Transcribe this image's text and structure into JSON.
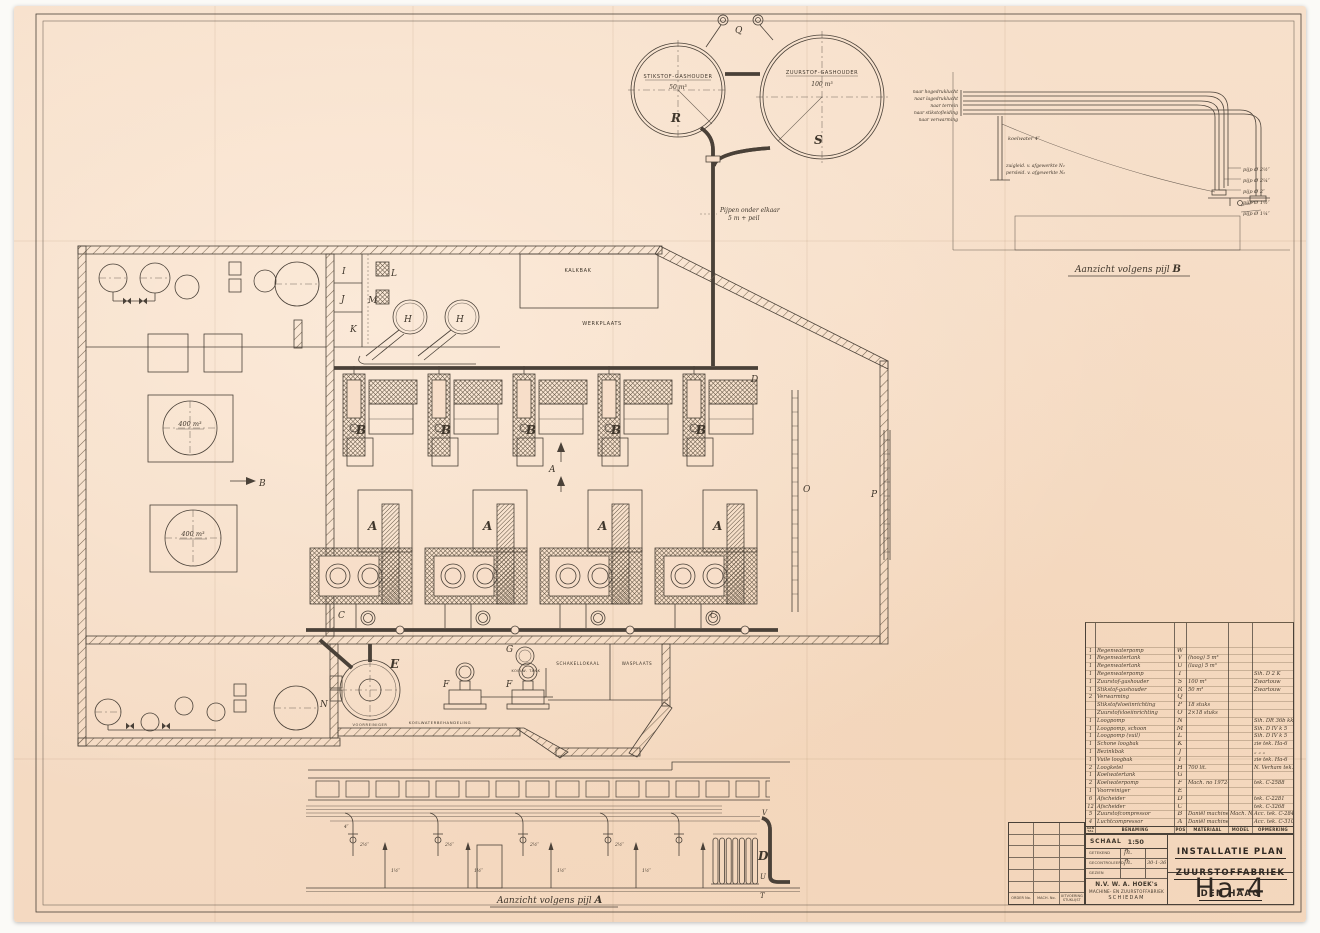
{
  "colors": {
    "paper": "#f6dcc6",
    "ink": "#4a4138"
  },
  "gas_holders": {
    "nitrogen": {
      "label": "STIKSTOF-GASHOUDER",
      "capacity": "50 m³",
      "letter": "R"
    },
    "oxygen": {
      "label": "ZUURSTOF-GASHOUDER",
      "capacity": "100 m³",
      "letter": "S"
    },
    "vent_letter": "Q",
    "pipe_note_line1": "Pijpen onder elkaar",
    "pipe_note_line2": "5 m + peil"
  },
  "view_b": {
    "caption_text": "Aanzicht volgens pijl ",
    "caption_letter": "B",
    "left_labels": [
      "naar hogedruklucht",
      "naar lagedruklucht",
      "naar terrein",
      "naar stikstofleiding",
      "naar verwarming"
    ],
    "right_labels": [
      "pijp Ø 2½″",
      "pijp Ø 2¼″",
      "pijp Ø 2″",
      "pijp Ø 1½″",
      "pijp Ø 1¼″"
    ],
    "support_label": "koelwater 4″",
    "note_line1": "zuigleid. v. afgewerkte N₂",
    "note_line2": "persleid. v. afgewerkte N₂"
  },
  "view_a": {
    "caption_text": "Aanzicht volgens pijl ",
    "caption_letter": "A",
    "letters": {
      "d": "D",
      "t": "T",
      "u": "U",
      "v": "V"
    },
    "pipe_sizes": [
      "4″",
      "2½″",
      "1½″"
    ]
  },
  "plan": {
    "rooms": {
      "kalkbak": "KALKBAK",
      "werkplaats": "WERKPLAATS",
      "schakellokaal": "SCHAKELLOKAAL",
      "wasplaats": "WASPLAATS",
      "koelwaterbehandeling": "KOELWATERBEHANDELING",
      "koelw_tank": "KOELW. TANK",
      "voorreiniger": "VOORREINIGER"
    },
    "tanks": {
      "basin1": "400 m³",
      "basin2": "400 m³"
    },
    "machine_letters": {
      "a": "A",
      "b": "B",
      "c": "C",
      "d": "D",
      "e": "E",
      "f": "F",
      "g": "G",
      "h": "H",
      "i": "I",
      "j": "J",
      "k": "K",
      "l": "L",
      "m": "M",
      "n": "N",
      "o": "O",
      "p": "P"
    },
    "view_arrow_b": "B",
    "section_marker_a": "A"
  },
  "parts_list": {
    "headers": {
      "aantal": "AAN TAL",
      "benaming": "BENAMING",
      "pos": "POS",
      "materiaal": "MATERIAAL",
      "model": "MODEL No",
      "opmerking": "OPMERKING"
    },
    "rows": [
      {
        "aantal": "1",
        "benaming": "Regenwaterpomp",
        "pos": "W",
        "materiaal": "",
        "model": "",
        "opmerking": ""
      },
      {
        "aantal": "1",
        "benaming": "Regenwatertank",
        "pos": "V",
        "materiaal": "(hoog) 5 m³",
        "model": "",
        "opmerking": ""
      },
      {
        "aantal": "1",
        "benaming": "Regenwatertank",
        "pos": "U",
        "materiaal": "(laag) 5 m³",
        "model": "",
        "opmerking": ""
      },
      {
        "aantal": "1",
        "benaming": "Regenwaterpomp",
        "pos": "T",
        "materiaal": "",
        "model": "",
        "opmerking": "Sih. D 2 K"
      },
      {
        "aantal": "1",
        "benaming": "Zuurstof-gashouder",
        "pos": "S",
        "materiaal": "100 m³",
        "model": "",
        "opmerking": "Zwartouw"
      },
      {
        "aantal": "1",
        "benaming": "Stikstof-gashouder",
        "pos": "R",
        "materiaal": "50 m³",
        "model": "",
        "opmerking": "Zwartouw"
      },
      {
        "aantal": "2",
        "benaming": "Verwarming",
        "pos": "Q",
        "materiaal": "",
        "model": "",
        "opmerking": ""
      },
      {
        "aantal": "",
        "benaming": "Stikstofvloeiinrichting",
        "pos": "P",
        "materiaal": "18 stuks",
        "model": "",
        "opmerking": ""
      },
      {
        "aantal": "",
        "benaming": "Zuurstofvloeiinrichting",
        "pos": "O",
        "materiaal": "2×18 stuks",
        "model": "",
        "opmerking": ""
      },
      {
        "aantal": "1",
        "benaming": "Loogpomp",
        "pos": "N",
        "materiaal": "",
        "model": "",
        "opmerking": "Sih. DR 36b kk 5"
      },
      {
        "aantal": "1",
        "benaming": "Loogpomp, schoon",
        "pos": "M",
        "materiaal": "",
        "model": "",
        "opmerking": "Sih. D IV k 5"
      },
      {
        "aantal": "1",
        "benaming": "Loogpomp (vuil)",
        "pos": "L",
        "materiaal": "",
        "model": "",
        "opmerking": "Sih. D IV k 5"
      },
      {
        "aantal": "1",
        "benaming": "Schone loogbak",
        "pos": "K",
        "materiaal": "",
        "model": "",
        "opmerking": "zie tek. Ha-6"
      },
      {
        "aantal": "1",
        "benaming": "Bezinkbak",
        "pos": "J",
        "materiaal": "",
        "model": "",
        "opmerking": "„  „  „"
      },
      {
        "aantal": "1",
        "benaming": "Vuile loogbak",
        "pos": "I",
        "materiaal": "",
        "model": "",
        "opmerking": "zie tek. Ha-6"
      },
      {
        "aantal": "2",
        "benaming": "Loogketel",
        "pos": "H",
        "materiaal": "700 lit.",
        "model": "",
        "opmerking": "N. Verham tek. 204-E"
      },
      {
        "aantal": "1",
        "benaming": "Koelwatertank",
        "pos": "G",
        "materiaal": "",
        "model": "",
        "opmerking": ""
      },
      {
        "aantal": "2",
        "benaming": "Koelwaterpomp",
        "pos": "F",
        "materiaal": "Mach. no 1972-1973",
        "model": "",
        "opmerking": "tek. C-2588"
      },
      {
        "aantal": "1",
        "benaming": "Voorreiniger",
        "pos": "E",
        "materiaal": "",
        "model": "",
        "opmerking": ""
      },
      {
        "aantal": "6",
        "benaming": "Afscheider",
        "pos": "D",
        "materiaal": "",
        "model": "",
        "opmerking": "tek. C-2281"
      },
      {
        "aantal": "12",
        "benaming": "Afscheider",
        "pos": "C",
        "materiaal": "",
        "model": "",
        "opmerking": "tek. C-3268"
      },
      {
        "aantal": "5",
        "benaming": "Zuurstofcompressor",
        "pos": "B",
        "materiaal": "Daniël machines",
        "model": "Mach. Nos",
        "opmerking": "Acc. tek. C-2846"
      },
      {
        "aantal": "4",
        "benaming": "Luchtcompressor",
        "pos": "A",
        "materiaal": "Daniël machine",
        "model": "",
        "opmerking": "Acc. tek. C-3105"
      }
    ]
  },
  "title_block": {
    "schaal_label": "SCHAAL",
    "schaal_value": "1:50",
    "getekend": "GETEKEND",
    "gecontroleerd": "GECONTROLEERD",
    "gezien": "GEZIEN",
    "signature": "fh.",
    "date": "30-1-36",
    "company_line1": "N.V. W. A. HOEK's",
    "company_line2": "MACHINE- EN ZUURSTOFFABRIEK",
    "company_line3": "SCHIEDAM",
    "title_line1": "INSTALLATIE PLAN",
    "title_line2": "ZUURSTOFFABRIEK",
    "title_line3": "DEN HAAG",
    "drawing_number": "Ha-4",
    "order_no": "ORDER No.",
    "mach_no": "MACH. No.",
    "uitvoering": "UITVOERING STUKLIJST"
  }
}
